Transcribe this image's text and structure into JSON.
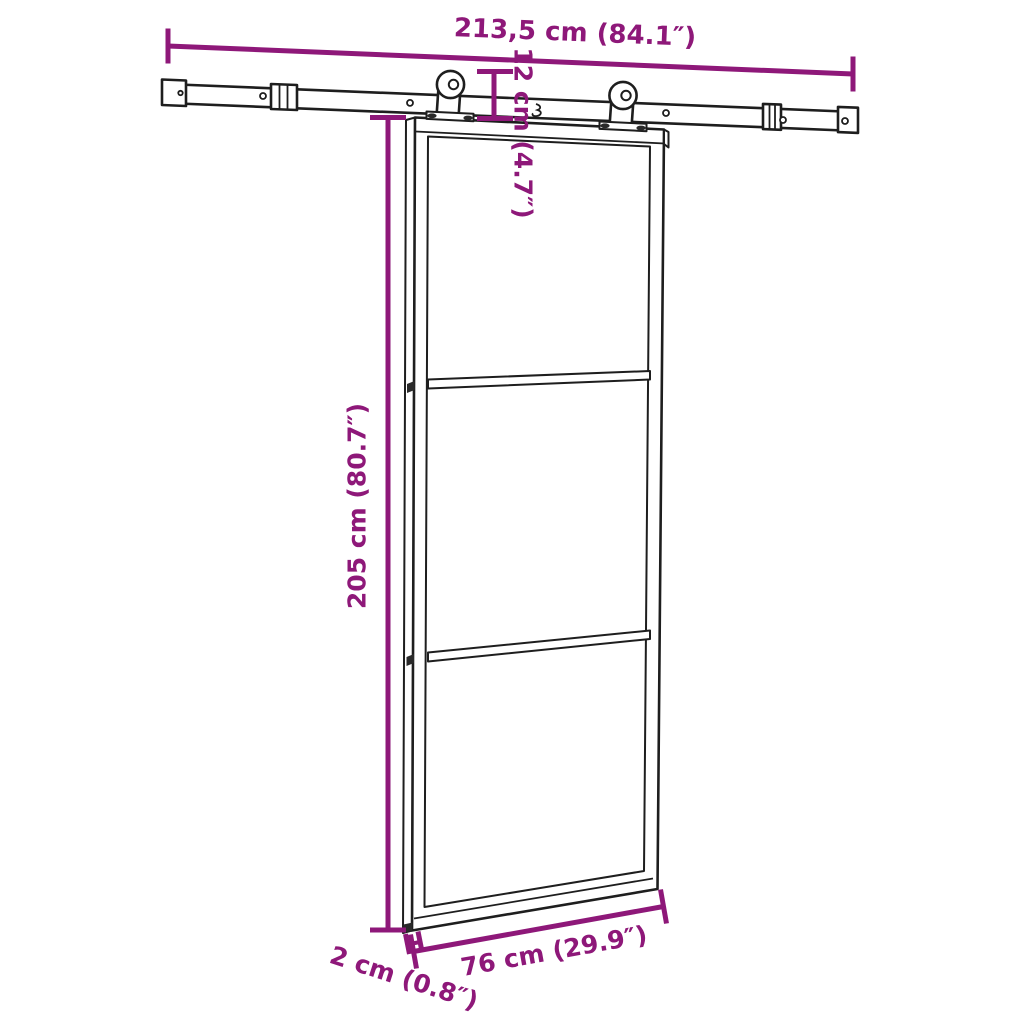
{
  "canvas": {
    "background": "#ffffff",
    "accent_color": "#8E1879",
    "line_color": "#1e1e1e"
  },
  "labels": {
    "rail_width": "213,5 cm (84.1″)",
    "hanger_drop": "12 cm (4.7″)",
    "door_height": "205 cm (80.7″)",
    "door_width": "76 cm (29.9″)",
    "door_thickness": "2 cm (0.8″)"
  }
}
